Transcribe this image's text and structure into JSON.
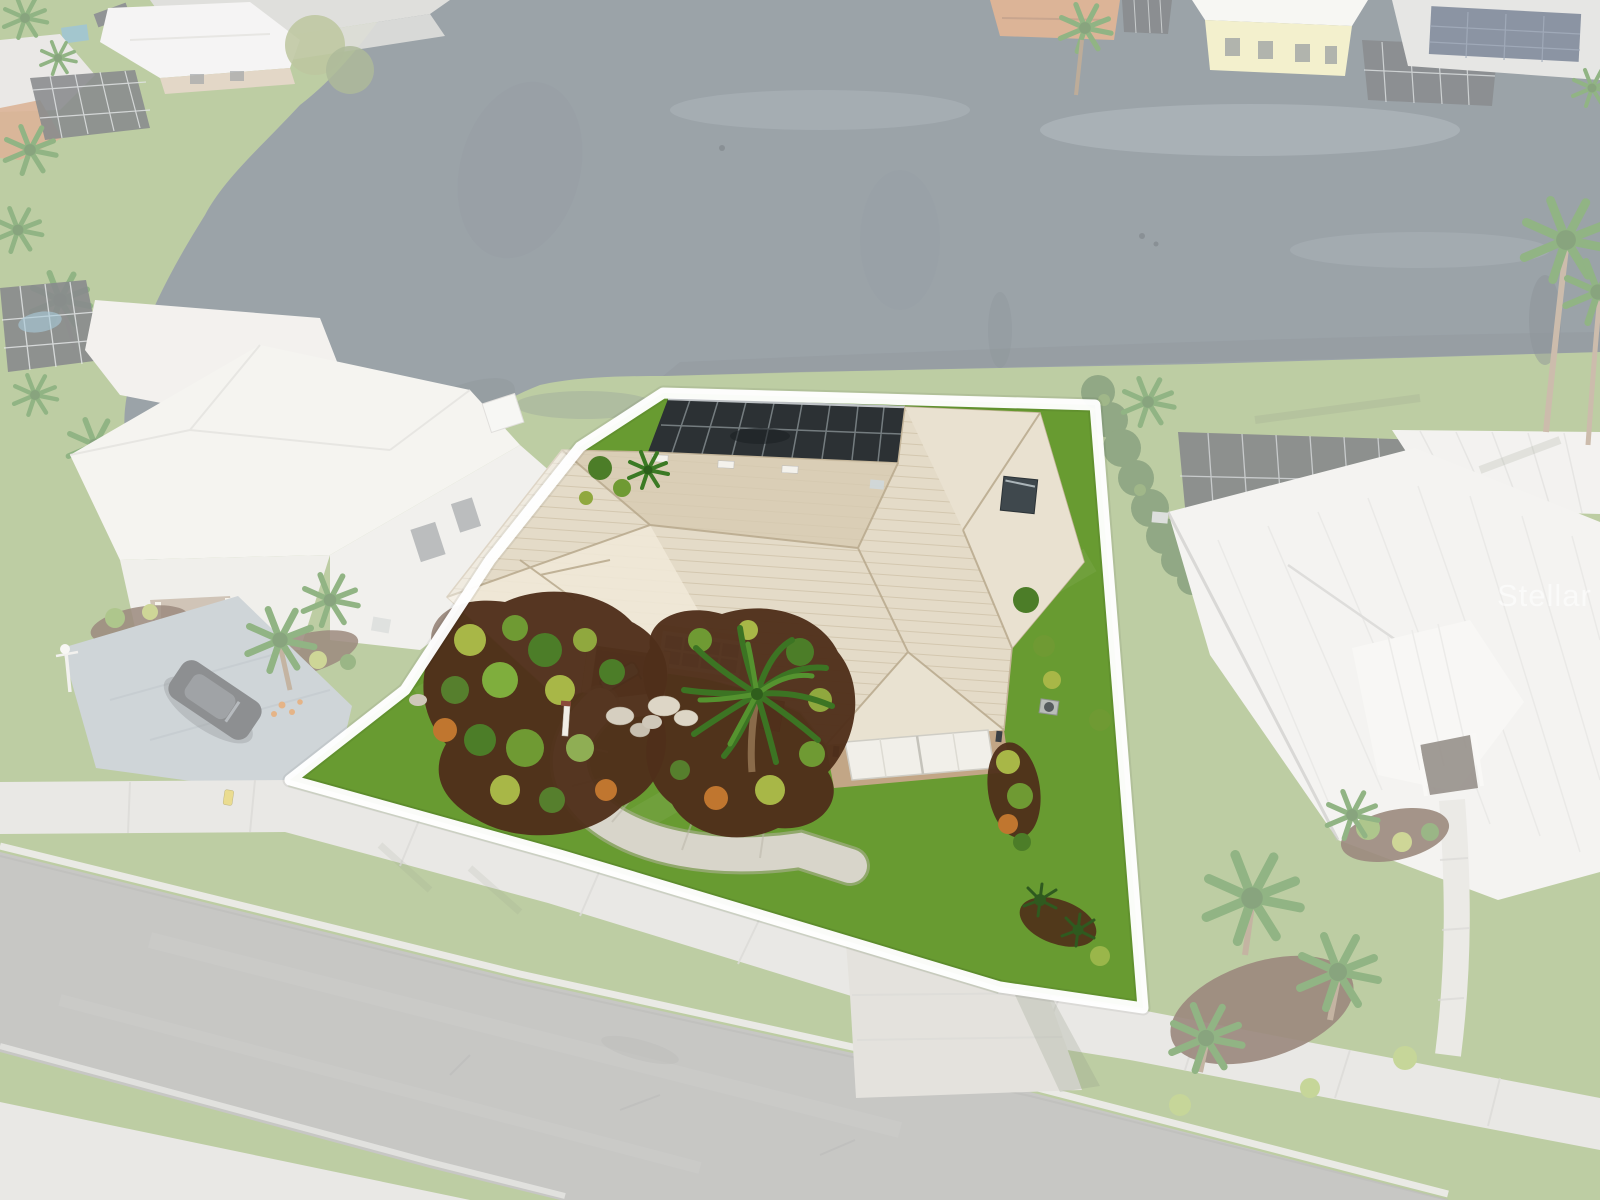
{
  "image": {
    "type": "aerial-drone-photograph",
    "subject": "Single-family Florida lakefront home with white property-boundary overlay; surroundings faded white, subject lot shown in full color",
    "width_px": 1600,
    "height_px": 1200
  },
  "watermark": {
    "text": "Stellar MLS",
    "color": "#ffffff",
    "opacity": "0.55"
  },
  "boundary": {
    "color": "#ffffff",
    "stroke_width": "11",
    "vertices": "663,393 1095,405 1143,1008 1000,987 560,855 290,780 405,690 490,560 580,447"
  },
  "palette": {
    "grass_base": "#8aa65c",
    "lawn": "#689b31",
    "lake": "#4d5b65",
    "lake_dark": "#39454c",
    "roof_tile": "#e4dbc8",
    "roof_shade": "#d7cbb2",
    "roof_light": "#efe8d7",
    "roof_metal": "#ebeae6",
    "wall_tan": "#c2a686",
    "garage_door": "#f1efe9",
    "window_pane": "#a3b3bb",
    "bench": "#5fb4a9",
    "mulch": "#4f2f1a",
    "shrub_green": "#4c7d28",
    "shrub_yellow": "#a8b747",
    "croton_orange": "#c0762f",
    "palm_green": "#3f7a26",
    "hedge": "#3c6426",
    "pool_cage": "#2c3134",
    "street": "#9b9b97",
    "sidewalk": "#d8d6d0",
    "driveway": "#cfccc2",
    "car": "#35383b",
    "orange_roof": "#c07947",
    "yellow_house": "#e9e4a6",
    "solar": "#31405c",
    "wash": "#ffffff"
  },
  "scene": {
    "pond": {
      "name": "community pond"
    },
    "subject_property": {
      "features": [
        "cream tile hip roof",
        "screened pool cage",
        "attached two-car garage",
        "white double garage door",
        "curved concrete walkway",
        "palm island planting beds",
        "teal porch bench",
        "gridded picture window",
        "concrete driveway"
      ]
    },
    "left_neighbor": {
      "features": [
        "white tile roof",
        "screened pool enclosure",
        "driveway with dark parked car",
        "front-yard lamp post",
        "palm trees"
      ]
    },
    "right_neighbor": {
      "features": [
        "white standing-seam metal roof",
        "screened pool enclosure",
        "privacy hedge",
        "entry walkway",
        "leaning palms"
      ]
    },
    "far_shore": {
      "features": [
        "street intersection",
        "white metal roofs",
        "yellow house",
        "solar-panel roof",
        "orange tile roof",
        "screened lanais",
        "palms and willows"
      ]
    },
    "street": {
      "name": "residential street",
      "sidewalk": "yes",
      "curb": "yes"
    }
  }
}
